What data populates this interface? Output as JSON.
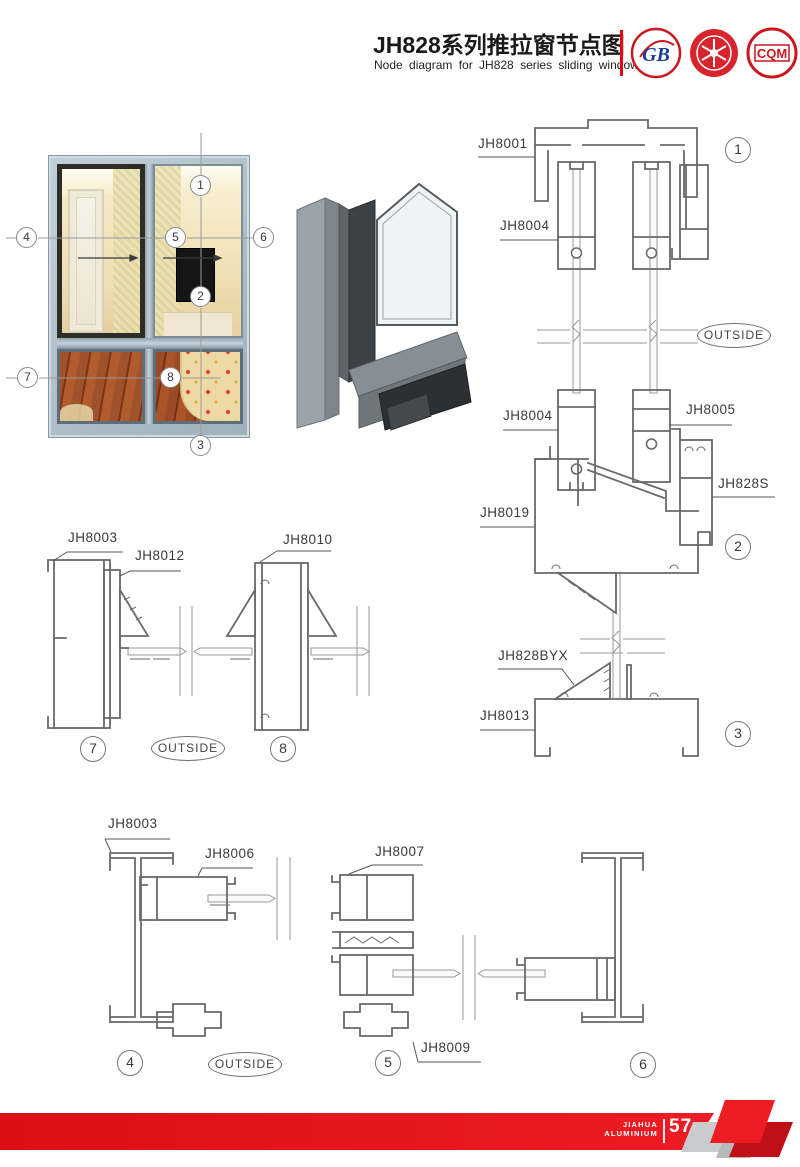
{
  "header": {
    "title_cn": "JH828系列推拉窗节点图",
    "title_en": "Node diagram for JH828 series sliding windows"
  },
  "logos": {
    "gb_text": "GB",
    "cqm_text": "CQM"
  },
  "parts": {
    "jh8001": "JH8001",
    "jh8003": "JH8003",
    "jh8004": "JH8004",
    "jh8005": "JH8005",
    "jh8006": "JH8006",
    "jh8007": "JH8007",
    "jh8009": "JH8009",
    "jh8010": "JH8010",
    "jh8012": "JH8012",
    "jh8013": "JH8013",
    "jh8019": "JH8019",
    "jh828s": "JH828S",
    "jh828byx": "JH828BYX"
  },
  "outside_label": "OUTSIDE",
  "callouts": {
    "c1": "1",
    "c2": "2",
    "c3": "3",
    "c4": "4",
    "c5": "5",
    "c6": "6",
    "c7": "7",
    "c8": "8"
  },
  "footer": {
    "brand_line1": "JIAHUA",
    "brand_line2": "ALUMINIUM",
    "page_number": "57"
  },
  "colors": {
    "accent_red": "#e60012",
    "line_gray": "#6a6a6a",
    "frame_blue_gray": "#aebdc7"
  }
}
